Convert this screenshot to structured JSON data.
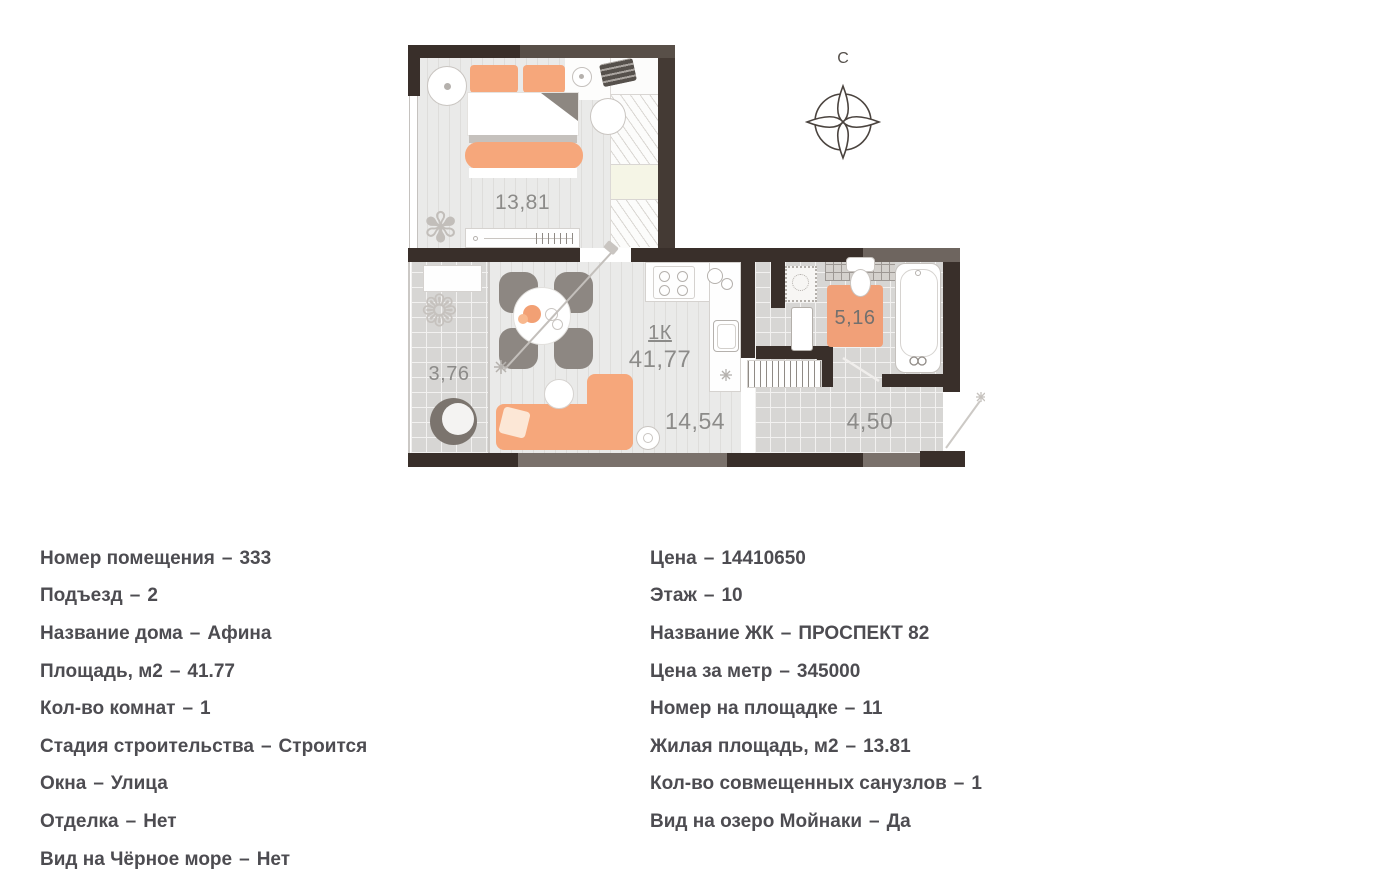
{
  "plan": {
    "compass_label": "С",
    "labels": {
      "bedroom_area": "13,81",
      "balcony_area": "3,76",
      "apartment_type": "1К",
      "total_area": "41,77",
      "kitchen_living_area": "14,54",
      "bathroom_area": "5,16",
      "hall_area": "4,50"
    }
  },
  "details": {
    "separator": "–",
    "left": [
      {
        "label": "Номер помещения",
        "value": "333"
      },
      {
        "label": "Подъезд",
        "value": "2"
      },
      {
        "label": "Название дома",
        "value": "Афина"
      },
      {
        "label": "Площадь, м2",
        "value": "41.77"
      },
      {
        "label": "Кол-во комнат",
        "value": "1"
      },
      {
        "label": "Стадия строительства",
        "value": "Строится"
      },
      {
        "label": "Окна",
        "value": "Улица"
      },
      {
        "label": "Отделка",
        "value": "Нет"
      },
      {
        "label": "Вид на Чёрное море",
        "value": "Нет"
      }
    ],
    "right": [
      {
        "label": "Цена",
        "value": "14410650"
      },
      {
        "label": "Этаж",
        "value": "10"
      },
      {
        "label": "Название ЖК",
        "value": "ПРОСПЕКТ 82"
      },
      {
        "label": "Цена за метр",
        "value": "345000"
      },
      {
        "label": "Номер на площадке",
        "value": "11"
      },
      {
        "label": "Жилая площадь, м2",
        "value": "13.81"
      },
      {
        "label": "Кол-во совмещенных санузлов",
        "value": "1"
      },
      {
        "label": "Вид на озеро Мойнаки",
        "value": "Да"
      }
    ]
  },
  "colors": {
    "accent_orange": "#f6a77b",
    "wall_dark": "#392f2a",
    "wall_medium": "#7a716b",
    "text": "#4d4c51",
    "label_gray": "#8c8b89"
  }
}
